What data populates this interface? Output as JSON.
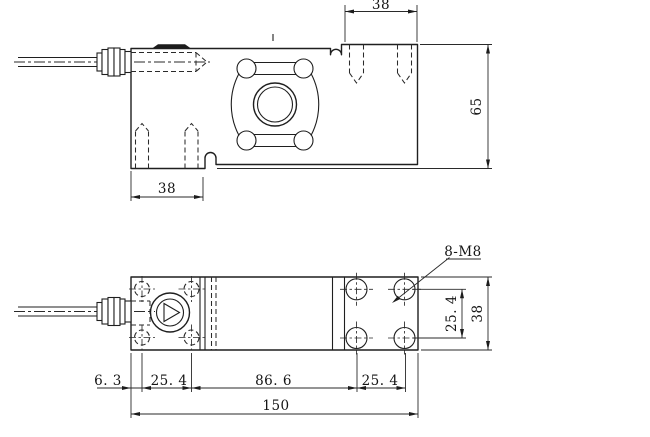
{
  "drawing": {
    "side_view": {
      "dim_top_width": "38",
      "dim_height": "65",
      "dim_bottom_width": "38"
    },
    "plan_view": {
      "thread_callout": "8-M8",
      "dim_hole_pitch_vertical": "25. 4",
      "dim_body_width": "38",
      "dim_edge_offset": "6. 3",
      "dim_left_hole_pitch": "25. 4",
      "dim_center_span": "86. 6",
      "dim_right_hole_pitch": "25. 4",
      "dim_total_length": "150"
    },
    "colors": {
      "line": "#1f1f1f",
      "background": "#ffffff"
    }
  }
}
